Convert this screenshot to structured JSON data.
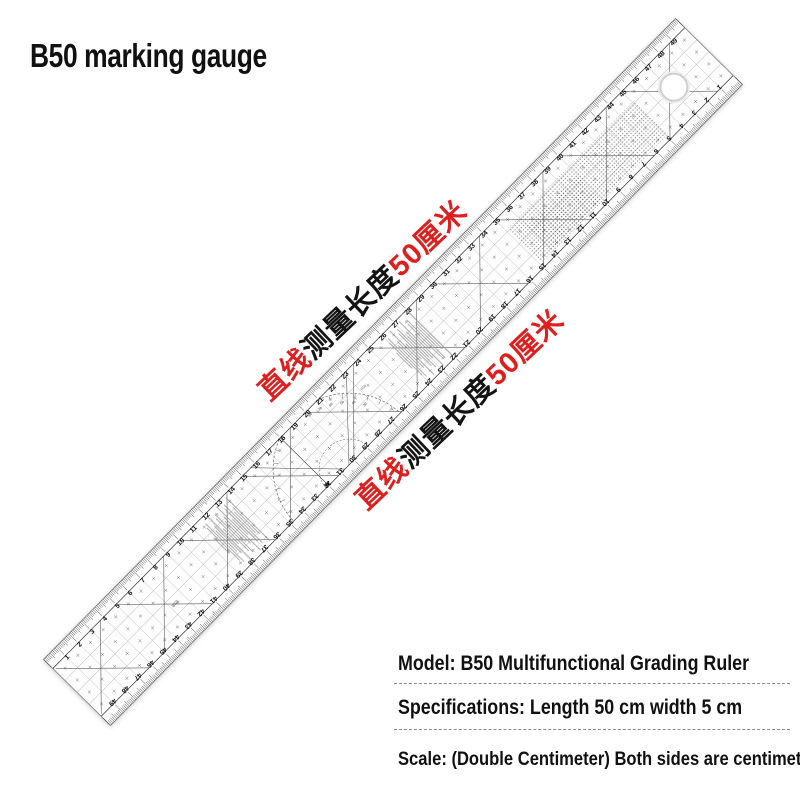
{
  "title": "B50 marking gauge",
  "annotations": [
    {
      "segments": [
        {
          "text": "直线",
          "color": "#df1f1e"
        },
        {
          "text": "测量长度",
          "color": "#141414"
        },
        {
          "text": "50厘米",
          "color": "#df1f1e"
        }
      ]
    },
    {
      "segments": [
        {
          "text": "直线",
          "color": "#df1f1e"
        },
        {
          "text": "测量长度",
          "color": "#141414"
        },
        {
          "text": "50厘米",
          "color": "#df1f1e"
        }
      ]
    }
  ],
  "specs": {
    "lines": [
      "Model: B50 Multifunctional Grading Ruler",
      "Specifications: Length 50 cm width 5 cm",
      "Scale: (Double Centimeter) Both sides are centimeters"
    ]
  },
  "ruler": {
    "length_cm": 50,
    "width_cm": 5,
    "scale_number_start": 1,
    "scale_number_end": 49,
    "protractor_degree_labels": [
      30,
      40,
      50,
      60,
      70,
      80
    ],
    "stamp_label": "B50",
    "colors": {
      "ink": "#1a1a1a",
      "body": "#fdfdfd",
      "annotation_red": "#df1f1e"
    }
  }
}
